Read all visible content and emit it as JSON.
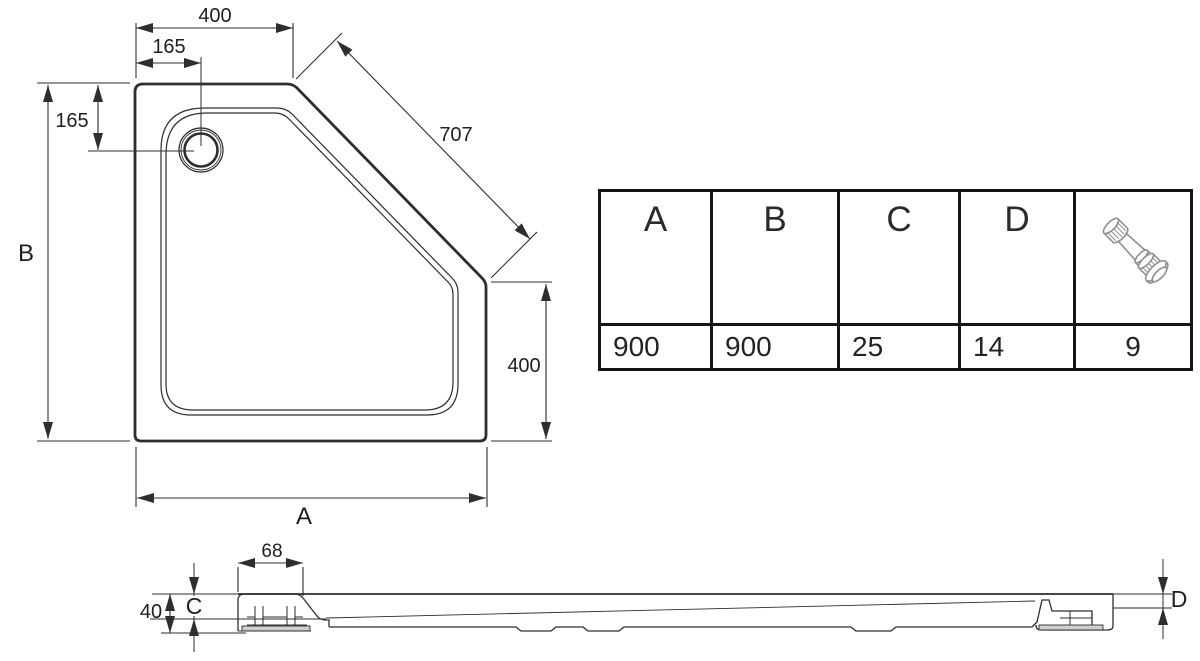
{
  "colors": {
    "line": "#2e2e2e",
    "text": "#1f1f1f",
    "table_border": "#161616",
    "icon_stroke": "#8f8f8f",
    "pad_fill": "#cfcfcf"
  },
  "plan_view": {
    "dim_top_edge": "400",
    "dim_drain_from_left": "165",
    "dim_drain_from_top": "165",
    "dim_diagonal_edge": "707",
    "dim_right_edge": "400",
    "dim_width_label": "A",
    "dim_depth_label": "B"
  },
  "section_view": {
    "dim_upstand_width": "68",
    "dim_overall_height": "40",
    "dim_inner_depth_label": "C",
    "dim_rim_thickness_label": "D"
  },
  "spec_table": {
    "columns": [
      {
        "header": "A",
        "value": "900"
      },
      {
        "header": "B",
        "value": "900"
      },
      {
        "header": "C",
        "value": "25"
      },
      {
        "header": "D",
        "value": "14"
      },
      {
        "header": "",
        "icon": "adjustable-foot-icon",
        "value": "9"
      }
    ]
  }
}
